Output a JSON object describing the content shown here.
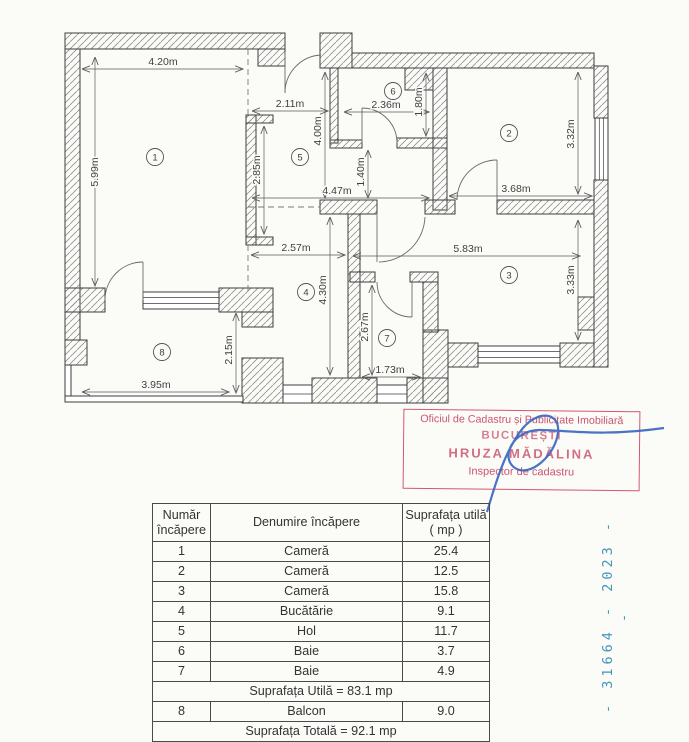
{
  "plan": {
    "rooms": [
      {
        "num": "1"
      },
      {
        "num": "2"
      },
      {
        "num": "3"
      },
      {
        "num": "4"
      },
      {
        "num": "5"
      },
      {
        "num": "6"
      },
      {
        "num": "7"
      },
      {
        "num": "8"
      }
    ],
    "dims": {
      "room1_width": "4.20m",
      "room1_height": "5.99m",
      "room1_inner_wall": "2.85m",
      "hall_entry_width": "2.11m",
      "hall_height": "4.00m",
      "hall_passage_height": "1.40m",
      "hall_width": "4.47m",
      "bath6_width": "2.36m",
      "bath6_height": "1.80m",
      "room2_height": "3.32m",
      "room2_width": "3.68m",
      "kitchen_width": "2.57m",
      "kitchen_height": "4.30m",
      "room3_width": "5.83m",
      "room3_height": "3.33m",
      "bath7_height": "2.67m",
      "bath7_width": "1.73m",
      "balcony_height": "2.15m",
      "balcony_width": "3.95m"
    }
  },
  "stamp": {
    "line1": "Oficiul de Cadastru și Publicitate Imobiliară",
    "line2": "BUCUREȘTI",
    "line3": "HRUZA MĂDĂLINA",
    "line4": "Inspector de cadastru"
  },
  "registration_number": "- 31664 - 2023 - -",
  "table": {
    "headers": {
      "col1": "Număr încăpere",
      "col2": "Denumire încăpere",
      "col3": "Suprafața utilă ( mp )"
    },
    "rows": [
      {
        "num": "1",
        "name": "Cameră",
        "area": "25.4"
      },
      {
        "num": "2",
        "name": "Cameră",
        "area": "12.5"
      },
      {
        "num": "3",
        "name": "Cameră",
        "area": "15.8"
      },
      {
        "num": "4",
        "name": "Bucătărie",
        "area": "9.1"
      },
      {
        "num": "5",
        "name": "Hol",
        "area": "11.7"
      },
      {
        "num": "6",
        "name": "Baie",
        "area": "3.7"
      },
      {
        "num": "7",
        "name": "Baie",
        "area": "4.9"
      }
    ],
    "subtotal": "Suprafața Utilă =  83.1 mp",
    "balcony_row": {
      "num": "8",
      "name": "Balcon",
      "area": "9.0"
    },
    "total": "Suprafața Totală = 92.1 mp"
  }
}
